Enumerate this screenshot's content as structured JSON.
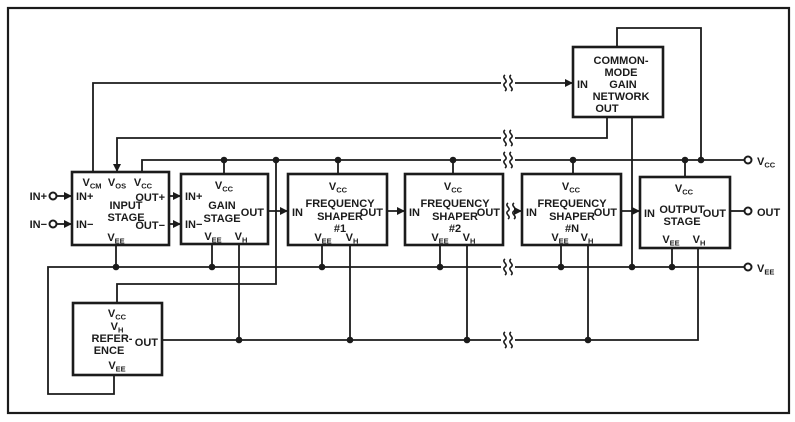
{
  "colors": {
    "ink": "#1b1b1b",
    "paper": "#ffffff"
  },
  "v_labels": {
    "cm": {
      "m": "V",
      "s": "CM"
    },
    "os": {
      "m": "V",
      "s": "OS"
    },
    "cc": {
      "m": "V",
      "s": "CC"
    },
    "ee": {
      "m": "V",
      "s": "EE"
    },
    "h": {
      "m": "V",
      "s": "H"
    }
  },
  "terminals": {
    "in_plus": "IN+",
    "in_minus": "IN−",
    "out": "OUT"
  },
  "blocks": {
    "input_stage": {
      "title": [
        "INPUT",
        "STAGE"
      ],
      "in_plus": "IN+",
      "in_minus": "IN−",
      "out_plus": "OUT+",
      "out_minus": "OUT−"
    },
    "gain_stage": {
      "title": [
        "GAIN",
        "STAGE"
      ],
      "in_plus": "IN+",
      "in_minus": "IN−",
      "out": "OUT"
    },
    "shaper1": {
      "title": [
        "FREQUENCY",
        "SHAPER",
        "#1"
      ],
      "in": "IN",
      "out": "OUT"
    },
    "shaper2": {
      "title": [
        "FREQUENCY",
        "SHAPER",
        "#2"
      ],
      "in": "IN",
      "out": "OUT"
    },
    "shaperN": {
      "title": [
        "FREQUENCY",
        "SHAPER",
        "#N"
      ],
      "in": "IN",
      "out": "OUT"
    },
    "output_stage": {
      "title": [
        "OUTPUT",
        "STAGE"
      ],
      "in": "IN",
      "out": "OUT"
    },
    "cm_network": {
      "title": [
        "COMMON-",
        "MODE",
        "GAIN",
        "NETWORK"
      ],
      "in": "IN",
      "out": "OUT"
    },
    "reference": {
      "title": [
        "REFER-",
        "ENCE"
      ],
      "out": "OUT"
    }
  }
}
